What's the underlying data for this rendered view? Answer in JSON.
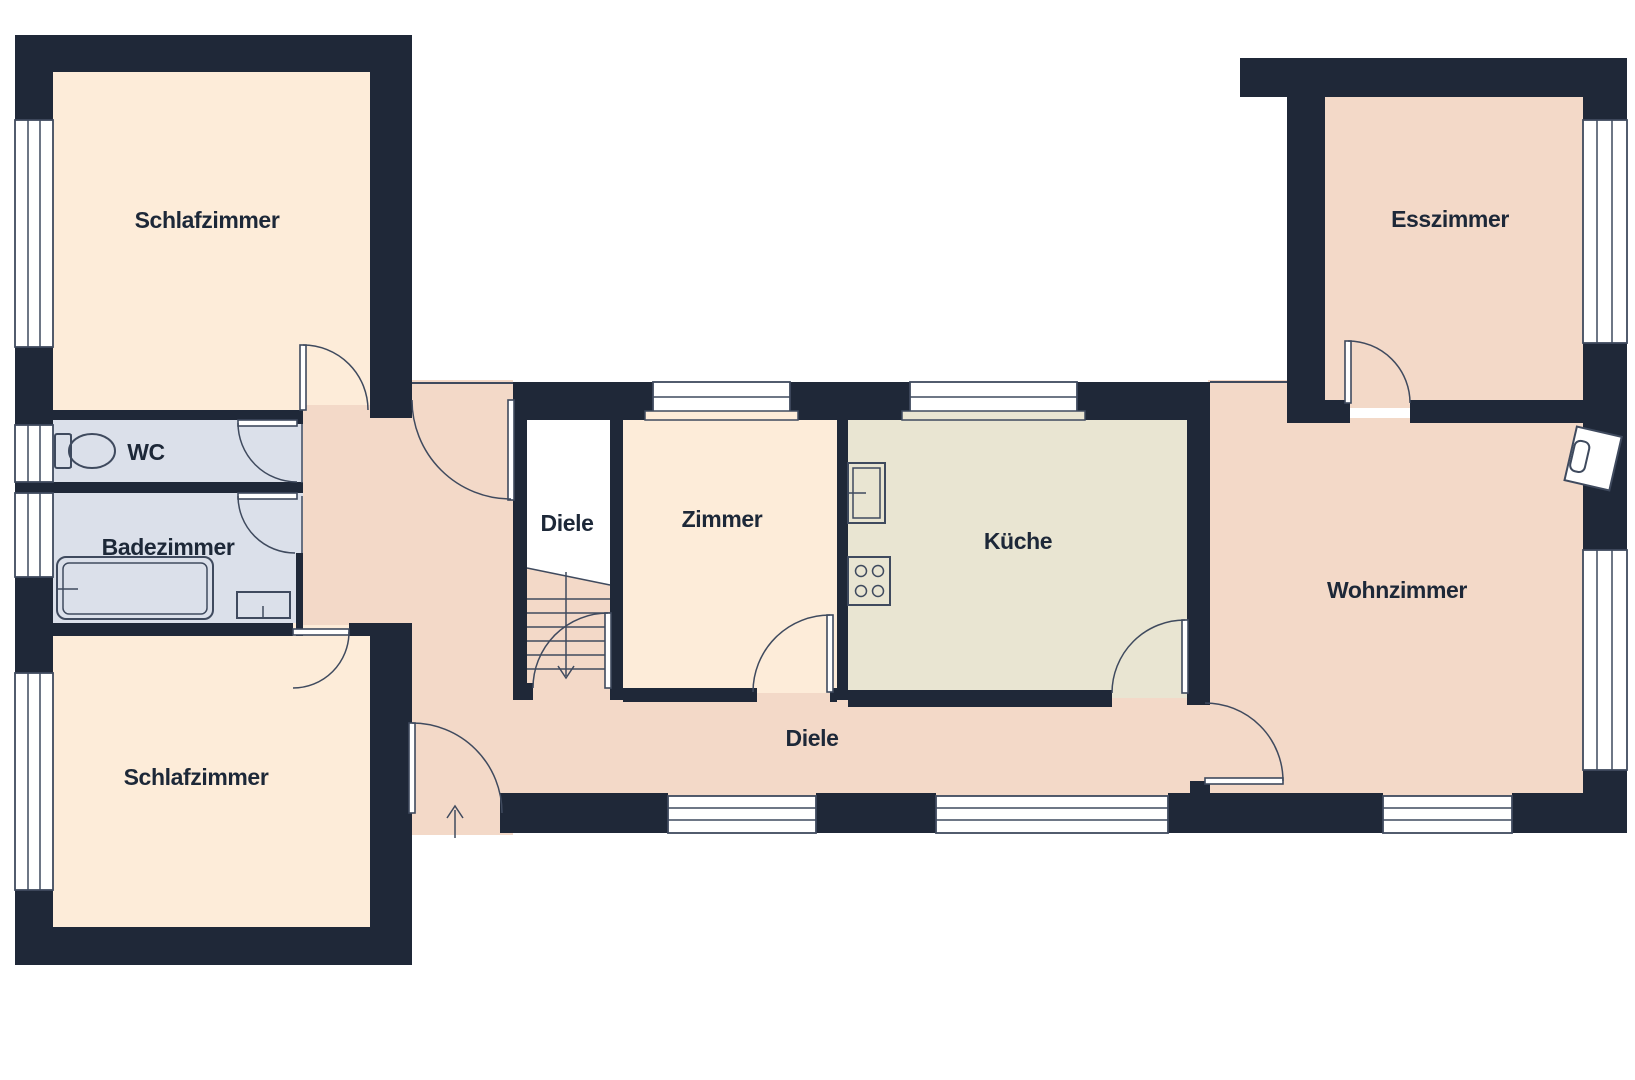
{
  "plan": {
    "type": "floor-plan",
    "language": "de",
    "rooms": [
      {
        "id": "schlafzimmer-nw",
        "label": "Schlafzimmer"
      },
      {
        "id": "wc",
        "label": "WC"
      },
      {
        "id": "badezimmer",
        "label": "Badezimmer"
      },
      {
        "id": "schlafzimmer-sw",
        "label": "Schlafzimmer"
      },
      {
        "id": "diele-treppe",
        "label": "Diele"
      },
      {
        "id": "zimmer",
        "label": "Zimmer"
      },
      {
        "id": "kueche",
        "label": "Küche"
      },
      {
        "id": "diele-flur",
        "label": "Diele"
      },
      {
        "id": "wohnzimmer",
        "label": "Wohnzimmer"
      },
      {
        "id": "esszimmer",
        "label": "Esszimmer"
      }
    ],
    "colors": {
      "wall": "#1f2838",
      "room_cream": "#fdecd9",
      "room_salmon": "#f3d9c8",
      "room_kitchen": "#e9e5d2",
      "room_bath": "#dbe0ea",
      "line": "#3f4a5e",
      "label": "#1d2838",
      "background": "#ffffff"
    }
  }
}
